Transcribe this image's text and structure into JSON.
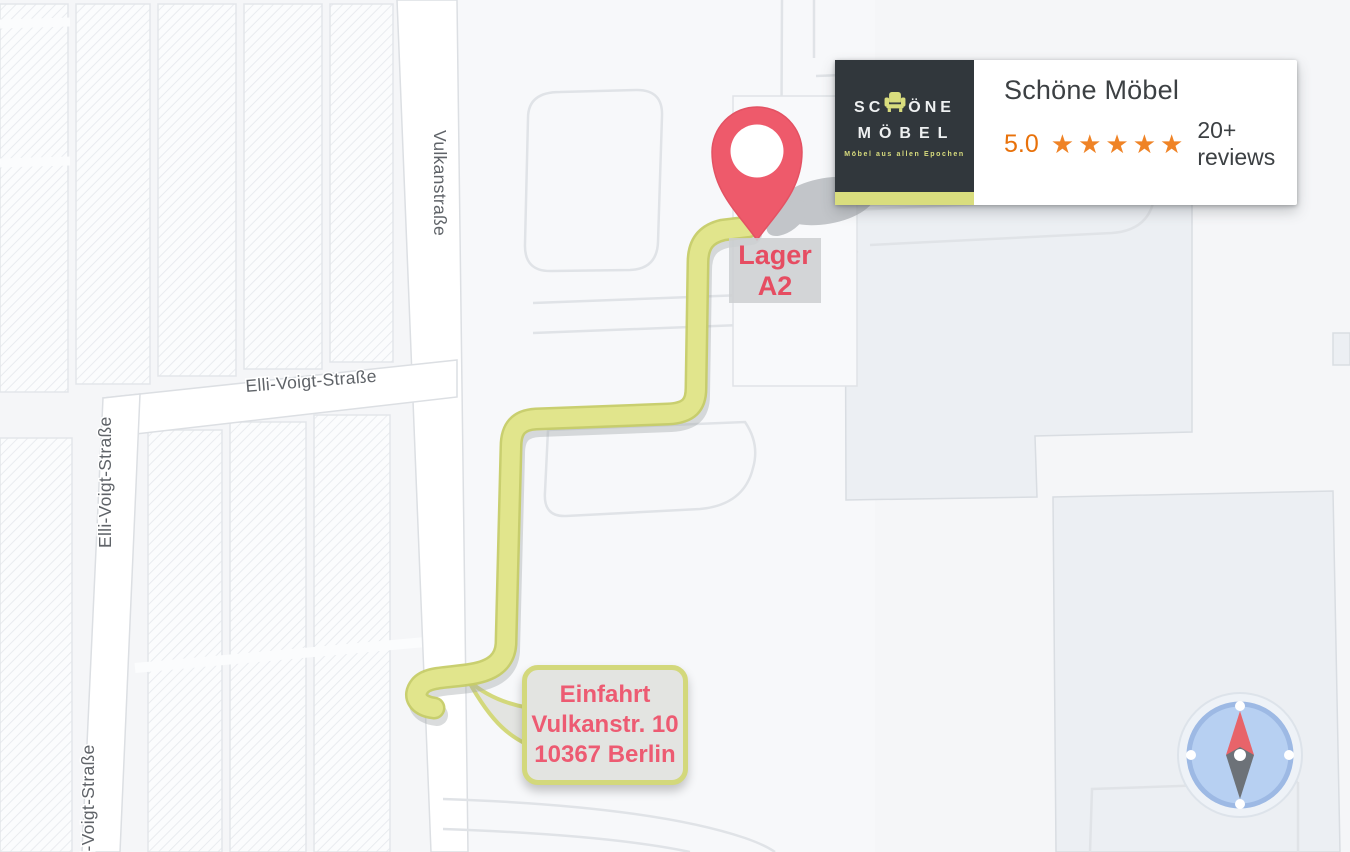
{
  "business_card": {
    "title": "Schöne Möbel",
    "rating_value": "5.0",
    "stars": "★★★★★",
    "reviews_label": "20+ reviews",
    "logo": {
      "word1_pre": "SC",
      "word1_post": "ÖNE",
      "word2": "MÖBEL",
      "tagline": "Möbel aus allen Epochen"
    }
  },
  "map": {
    "street_labels": {
      "vulkanstrasse": "Vulkanstraße",
      "elli_voigt_strasse": "Elli-Voigt-Straße"
    },
    "marker_label": {
      "line1": "Lager",
      "line2": "A2"
    },
    "entrance_callout": {
      "line1": "Einfahrt",
      "line2": "Vulkanstr. 10",
      "line3": "10367 Berlin"
    },
    "colors": {
      "route_fill": "#e1e58c",
      "route_edge": "#c6cc67",
      "pin_red": "#ee5a6b",
      "label_red": "#e64d62",
      "rating_orange": "#e8710a",
      "star_orange": "#ef8326",
      "logo_background": "#31373c",
      "logo_accent": "#d9dd7e",
      "compass_blue": "#b7d0f2"
    }
  }
}
